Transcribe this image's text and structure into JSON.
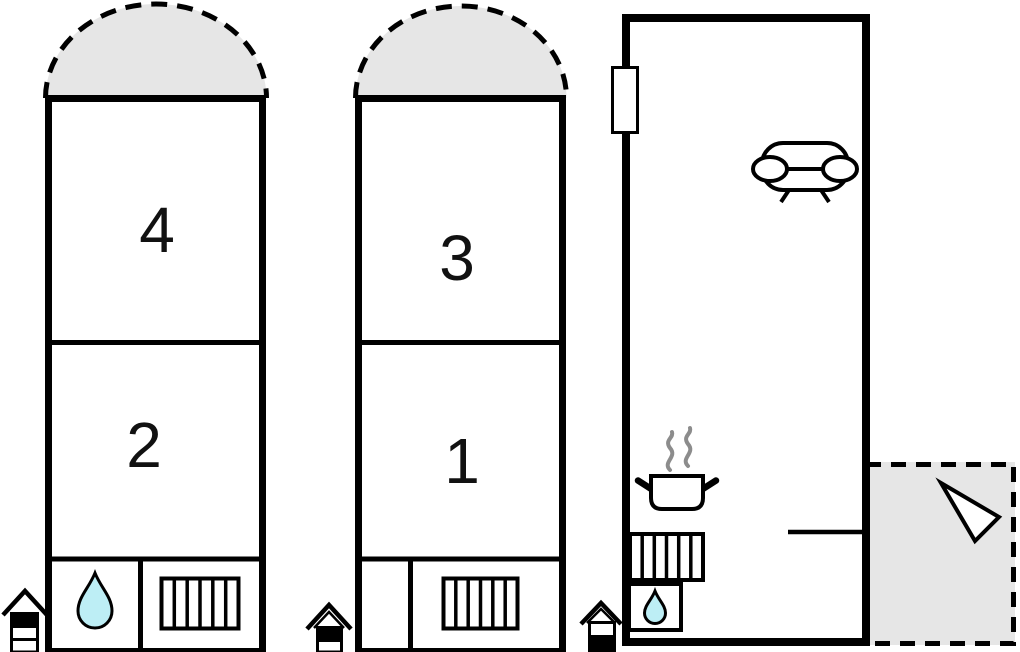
{
  "plan": {
    "type": "floor-plan",
    "colors": {
      "wall": "#000000",
      "area_fill": "#e6e6e6",
      "water": "#bdeef5",
      "steam": "#8c8c8c",
      "background": "#ffffff"
    },
    "rooms": {
      "room4": {
        "label": "4"
      },
      "room2": {
        "label": "2"
      },
      "room3": {
        "label": "3"
      },
      "room1": {
        "label": "1"
      }
    },
    "icons": [
      "balcony-dashed-semicircle",
      "water-drop",
      "stairs",
      "entrance-house",
      "window",
      "sofa",
      "cooking-pot-with-steam",
      "terrace-dashed-area",
      "direction-arrow"
    ]
  }
}
